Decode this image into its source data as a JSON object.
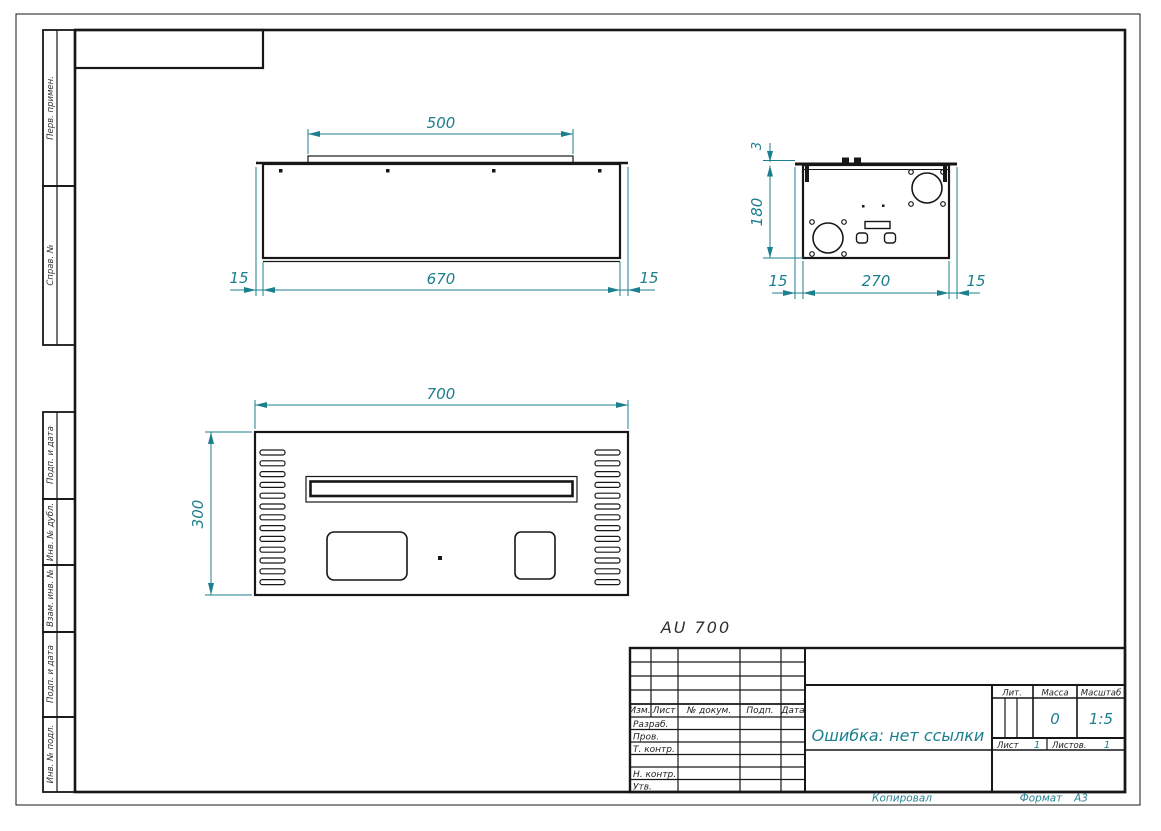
{
  "colors": {
    "dimension": "#1c7f8e",
    "line": "#171717"
  },
  "caption": "AU 700",
  "side_labels": [
    "Перв. примен.",
    "Справ. №",
    "Подп. и дата",
    "Инв. № дубл.",
    "Взам. инв. №",
    "Подп. и дата",
    "Инв. № подл."
  ],
  "title_block": {
    "header_cols": [
      "Изм.",
      "Лист",
      "№ докум.",
      "Подп.",
      "Дата"
    ],
    "row_labels": [
      "Разраб.",
      "Пров.",
      "Т. контр.",
      "Н. контр.",
      "Утв."
    ],
    "doc_name": "Ошибка: нет ссылки",
    "lit_label": "Лит.",
    "mass_label": "Масса",
    "scale_label": "Масштаб",
    "mass_value": "0",
    "scale_value": "1:5",
    "sheet_label": "Лист",
    "sheet_value": "1",
    "sheets_label": "Листов.",
    "sheets_value": "1"
  },
  "footer": {
    "copied": "Копировал",
    "format_label": "Формат",
    "format_value": "А3"
  },
  "dims": {
    "front": {
      "strip": "500",
      "body": "670",
      "left": "15",
      "right": "15"
    },
    "side": {
      "lid": "3",
      "height": "180",
      "left": "15",
      "width": "270",
      "right": "15"
    },
    "top": {
      "width": "700",
      "depth": "300"
    }
  }
}
